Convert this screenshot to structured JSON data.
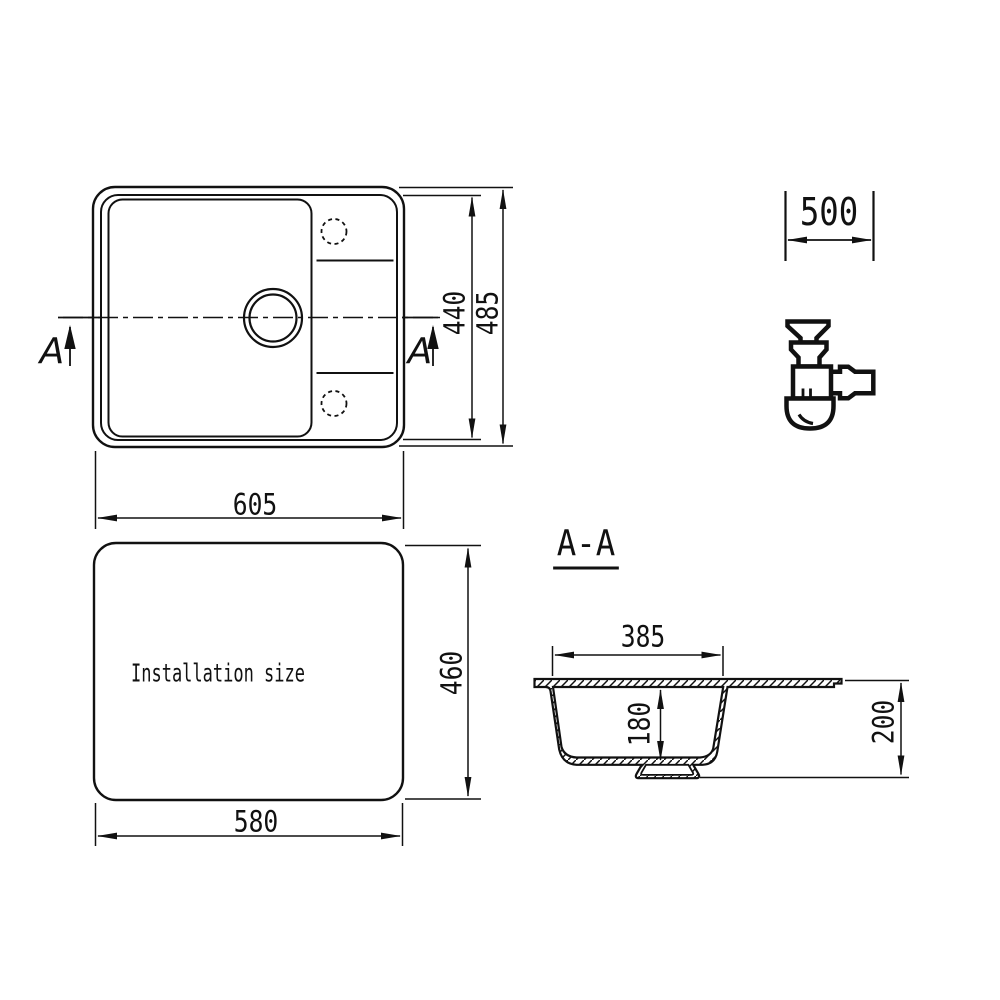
{
  "colors": {
    "ink": "#111111",
    "background": "#ffffff"
  },
  "top_view": {
    "section_label_left": "A",
    "section_label_right": "A",
    "width_mm": "605",
    "inner_height_mm": "440",
    "overall_height_mm": "485"
  },
  "installation_view": {
    "caption": "Installation size",
    "width_mm": "580",
    "height_mm": "460"
  },
  "section_view": {
    "title": "A-A",
    "bowl_width_mm": "385",
    "bowl_depth_mm": "180",
    "overall_depth_mm": "200"
  },
  "cabinet": {
    "min_width_mm": "500"
  },
  "icons": {
    "siphon": "siphon-trap-icon"
  }
}
